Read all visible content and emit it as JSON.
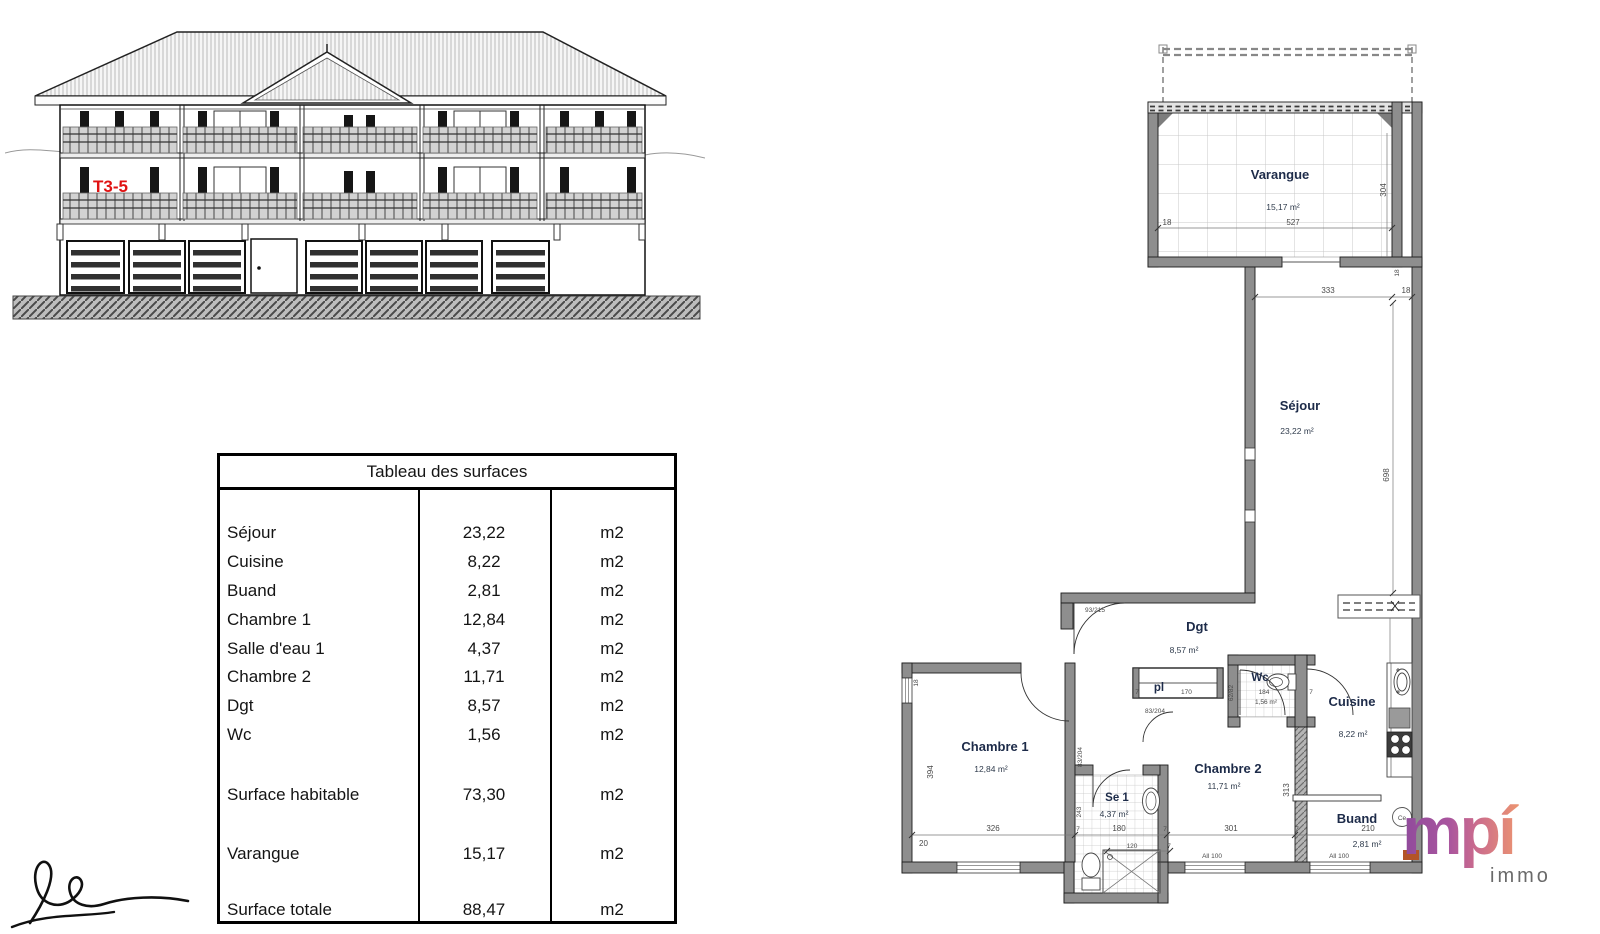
{
  "elevation": {
    "unit_label": "T3-5"
  },
  "table": {
    "title": "Tableau des surfaces",
    "rows": [
      {
        "label": "Séjour",
        "value": "23,22",
        "unit": "m2"
      },
      {
        "label": "Cuisine",
        "value": "8,22",
        "unit": "m2"
      },
      {
        "label": "Buand",
        "value": "2,81",
        "unit": "m2"
      },
      {
        "label": "Chambre 1",
        "value": "12,84",
        "unit": "m2"
      },
      {
        "label": "Salle d'eau 1",
        "value": "4,37",
        "unit": "m2"
      },
      {
        "label": "Chambre 2",
        "value": "11,71",
        "unit": "m2"
      },
      {
        "label": "Dgt",
        "value": "8,57",
        "unit": "m2"
      },
      {
        "label": "Wc",
        "value": "1,56",
        "unit": "m2"
      }
    ],
    "summary_rows": [
      {
        "label": "Surface habitable",
        "value": "73,30",
        "unit": "m2"
      },
      {
        "label": "Varangue",
        "value": "15,17",
        "unit": "m2"
      },
      {
        "label": "Surface totale",
        "value": "88,47",
        "unit": "m2"
      }
    ]
  },
  "floorplan": {
    "rooms": {
      "varangue": {
        "name": "Varangue",
        "area": "15,17 m²"
      },
      "sejour": {
        "name": "Séjour",
        "area": "23,22 m²"
      },
      "dgt": {
        "name": "Dgt",
        "area": "8,57 m²"
      },
      "pl": {
        "name": "pl"
      },
      "wc": {
        "name": "Wc",
        "area": "1,56 m²",
        "width": "184"
      },
      "chambre1": {
        "name": "Chambre 1",
        "area": "12,84 m²"
      },
      "se1": {
        "name": "Se 1",
        "area": "4,37 m²"
      },
      "chambre2": {
        "name": "Chambre 2",
        "area": "11,71 m²"
      },
      "cuisine": {
        "name": "Cuisine",
        "area": "8,22 m²"
      },
      "buand": {
        "name": "Buand",
        "area": "2,81 m²"
      }
    },
    "dims": {
      "d527": "527",
      "d18": "18",
      "d304": "304",
      "d333": "333",
      "d698": "698",
      "d20": "20",
      "d326": "326",
      "d394": "394",
      "d243": "243",
      "d180": "180",
      "d120": "120",
      "d301": "301",
      "d313": "313",
      "d210": "210",
      "d170": "170",
      "d7": "7",
      "door_entrance": "93/215",
      "door_83204": "83/204",
      "door_wc": "62/82",
      "allege": "All 100",
      "ce_label": "Ce"
    }
  },
  "logo": {
    "name": "mpí",
    "sub": "immo"
  }
}
